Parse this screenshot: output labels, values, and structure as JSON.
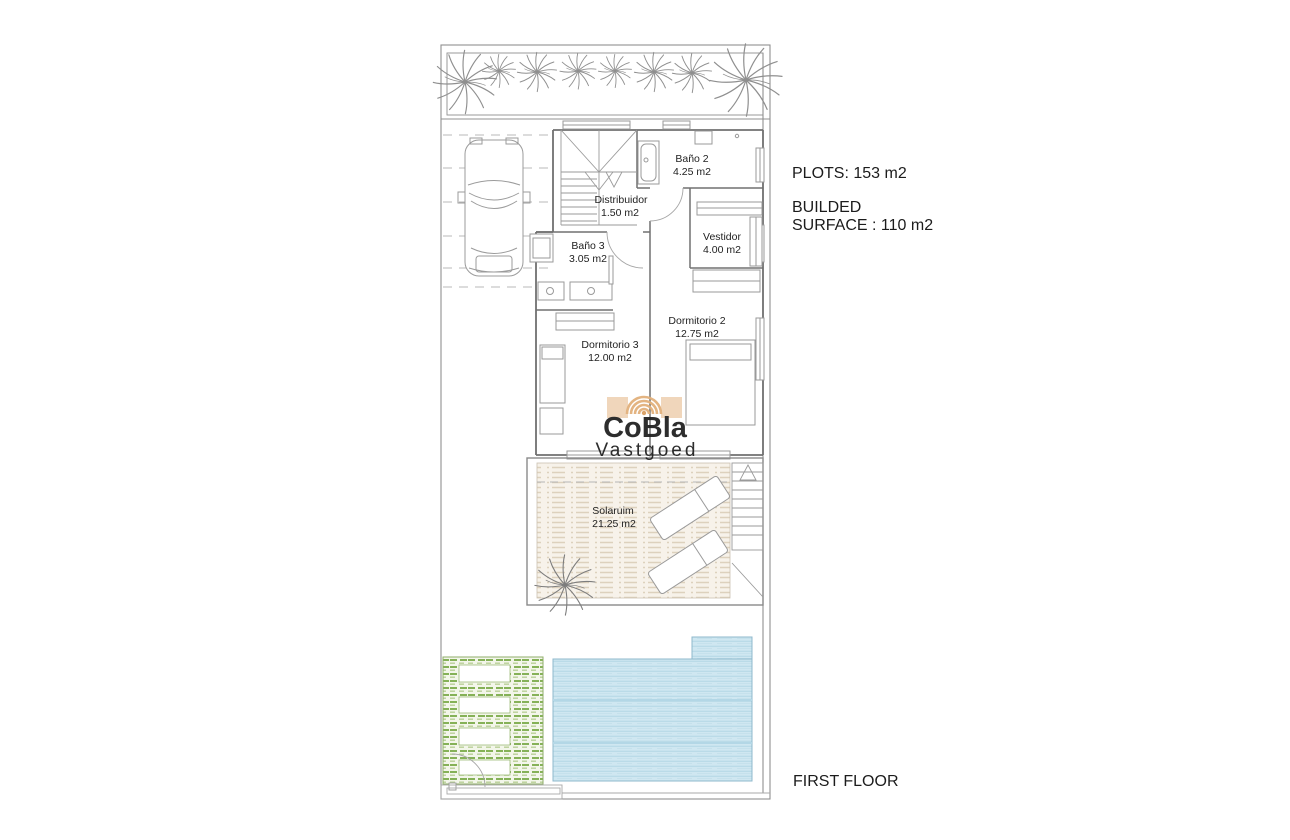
{
  "plan": {
    "floor_title": "FIRST FLOOR",
    "rooms": [
      {
        "id": "bano2",
        "name": "Baño 2",
        "area": "4.25 m2"
      },
      {
        "id": "distribuidor",
        "name": "Distribuidor",
        "area": "1.50 m2"
      },
      {
        "id": "vestidor",
        "name": "Vestidor",
        "area": "4.00 m2"
      },
      {
        "id": "bano3",
        "name": "Baño 3",
        "area": "3.05 m2"
      },
      {
        "id": "dormitorio2",
        "name": "Dormitorio 2",
        "area": "12.75 m2"
      },
      {
        "id": "dormitorio3",
        "name": "Dormitorio 3",
        "area": "12.00 m2"
      },
      {
        "id": "solarium",
        "name": "Solaruim",
        "area": "21.25 m2"
      }
    ]
  },
  "annotations": {
    "plots": "PLOTS: 153 m2",
    "builded_line1": "BUILDED",
    "builded_line2": "SURFACE : 110 m2",
    "floor_label": "FIRST FLOOR"
  },
  "logo": {
    "brand": "CoBla",
    "tagline": "Vastgoed"
  },
  "colors": {
    "logo_gray": "#58595b",
    "logo_tan": "#e2b17c",
    "pool_fill": "#cfe7f1",
    "pool_line": "#b3d7e6",
    "garden_green": "#85b157",
    "deck_beige": "#ddd1bd",
    "plan_line": "#8c8c8c",
    "wall": "#707070",
    "text": "#1c1c1c"
  }
}
